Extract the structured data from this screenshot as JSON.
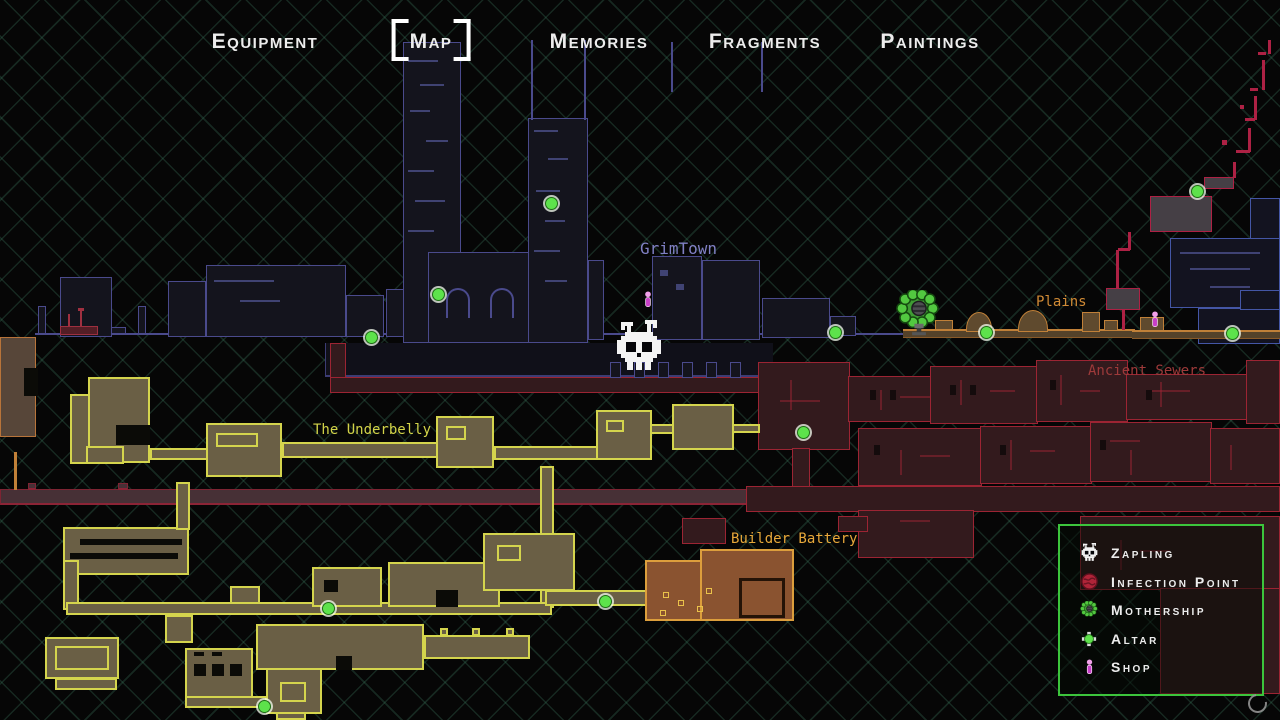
{
  "nav": {
    "tabs": [
      {
        "label": "Equipment",
        "selected": false
      },
      {
        "label": "Map",
        "selected": true
      },
      {
        "label": "Memories",
        "selected": false
      },
      {
        "label": "Fragments",
        "selected": false
      },
      {
        "label": "Paintings",
        "selected": false
      }
    ]
  },
  "regions": {
    "grimtown": {
      "label": "GrimTown",
      "label_color": "#8080c4",
      "fill": "#14141d",
      "border": "#4a4a8c"
    },
    "plains": {
      "label": "Plains",
      "label_color": "#d08a35",
      "fill": "#5f4a2e",
      "border": "#c08038"
    },
    "ancient_sewers": {
      "label": "Ancient Sewers",
      "label_color": "#9e3a3a",
      "fill": "#331a1d",
      "border": "#9c2433"
    },
    "underbelly": {
      "label": "The Underbelly",
      "label_color": "#d3d449",
      "fill": "#6a5f45",
      "border": "#d4d44d"
    },
    "builder_battery": {
      "label": "Builder Battery",
      "label_color": "#e8a83a",
      "fill": "#8a5330",
      "border": "#dc9e3c"
    },
    "infection": {
      "fill": "#453f45",
      "border": "#ad2144"
    }
  },
  "legend": {
    "border_color": "#3cc43c",
    "items": [
      {
        "icon": "zapling-icon",
        "label": "Zapling"
      },
      {
        "icon": "infection-point-icon",
        "label": "Infection Point"
      },
      {
        "icon": "mothership-icon",
        "label": "Mothership"
      },
      {
        "icon": "altar-icon",
        "label": "Altar"
      },
      {
        "icon": "shop-icon",
        "label": "Shop"
      }
    ]
  },
  "markers": {
    "altar_color": "#5de24b",
    "shop_color": "#c83fc8",
    "altars": [
      [
        437,
        293
      ],
      [
        550,
        202
      ],
      [
        370,
        336
      ],
      [
        834,
        331
      ],
      [
        985,
        331
      ],
      [
        1196,
        190
      ],
      [
        1231,
        332
      ],
      [
        802,
        431
      ],
      [
        327,
        607
      ],
      [
        604,
        600
      ],
      [
        263,
        705
      ]
    ],
    "shops": [
      [
        648,
        301
      ],
      [
        1155,
        321
      ]
    ],
    "player": [
      613,
      320
    ],
    "mothership": [
      895,
      290
    ]
  }
}
